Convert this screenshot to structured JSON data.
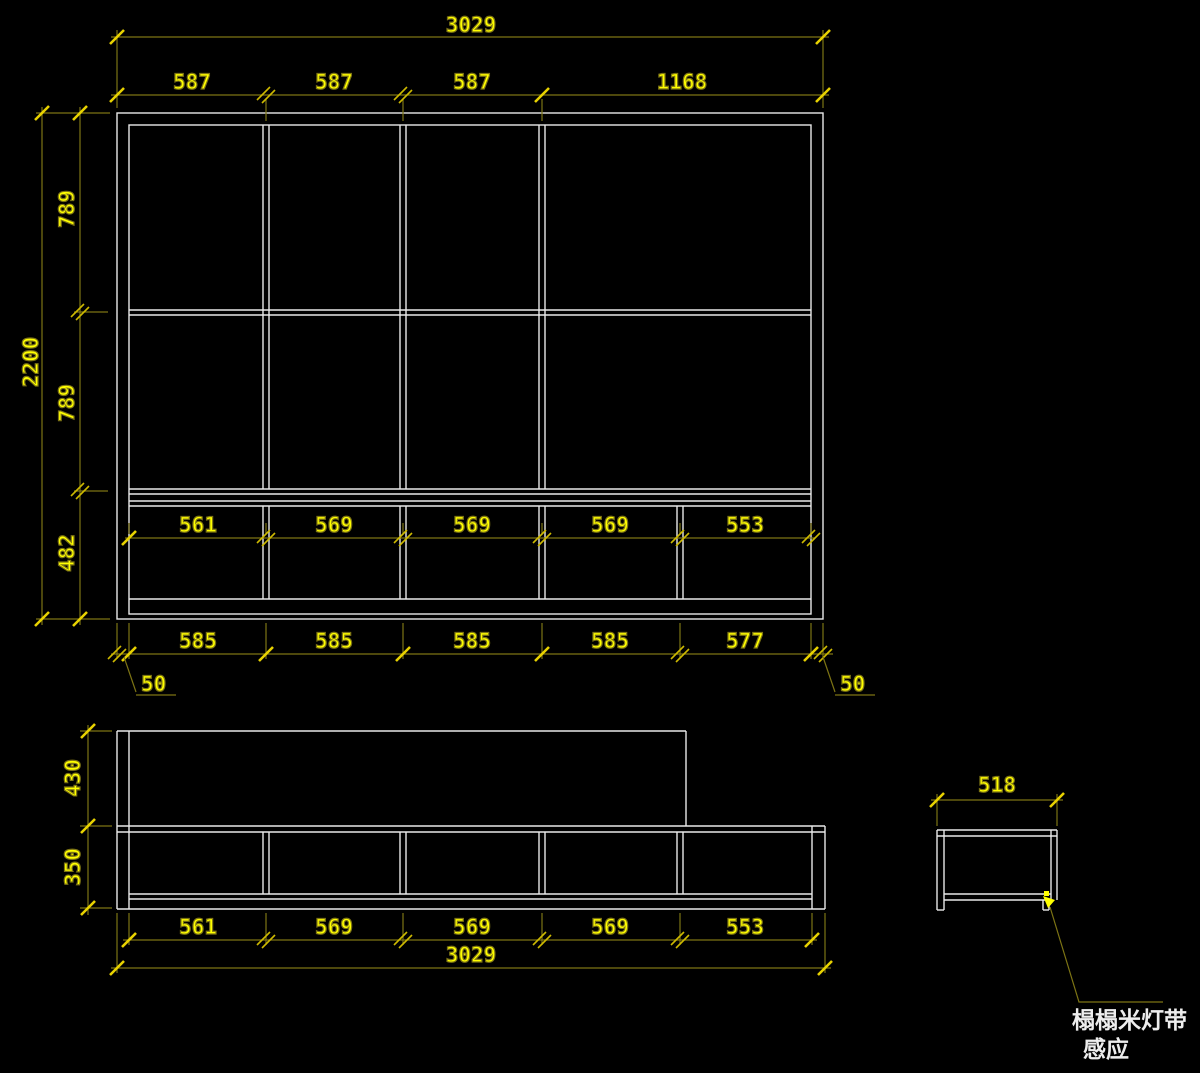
{
  "app": {
    "type": "cad-drawing",
    "background": "#000000"
  },
  "colors": {
    "outline": "#e9e9e9",
    "dimension_line": "#7d7414",
    "tick": "#e8d200",
    "dimension_text": "#ffff00",
    "annotation_text": "#ededed"
  },
  "views": {
    "cabinet_front_elevation": {
      "overall_width": "3029",
      "column_widths": [
        "587",
        "587",
        "587",
        "1168"
      ],
      "overall_height": "2200",
      "row_heights": [
        "789",
        "789",
        "482"
      ],
      "drawer_cell_widths": [
        "561",
        "569",
        "569",
        "569",
        "553"
      ],
      "module_pitches": [
        "585",
        "585",
        "585",
        "585",
        "577"
      ],
      "left_panel_thickness": "50",
      "right_panel_thickness": "50"
    },
    "platform_front_elevation": {
      "upper_cabinet_height": "430",
      "base_height": "350",
      "cell_widths": [
        "561",
        "569",
        "569",
        "569",
        "553"
      ],
      "overall_width": "3029"
    },
    "platform_side_section": {
      "depth": "518",
      "leader_note_line1": "榻榻米灯带",
      "leader_note_line2": "感应"
    }
  }
}
